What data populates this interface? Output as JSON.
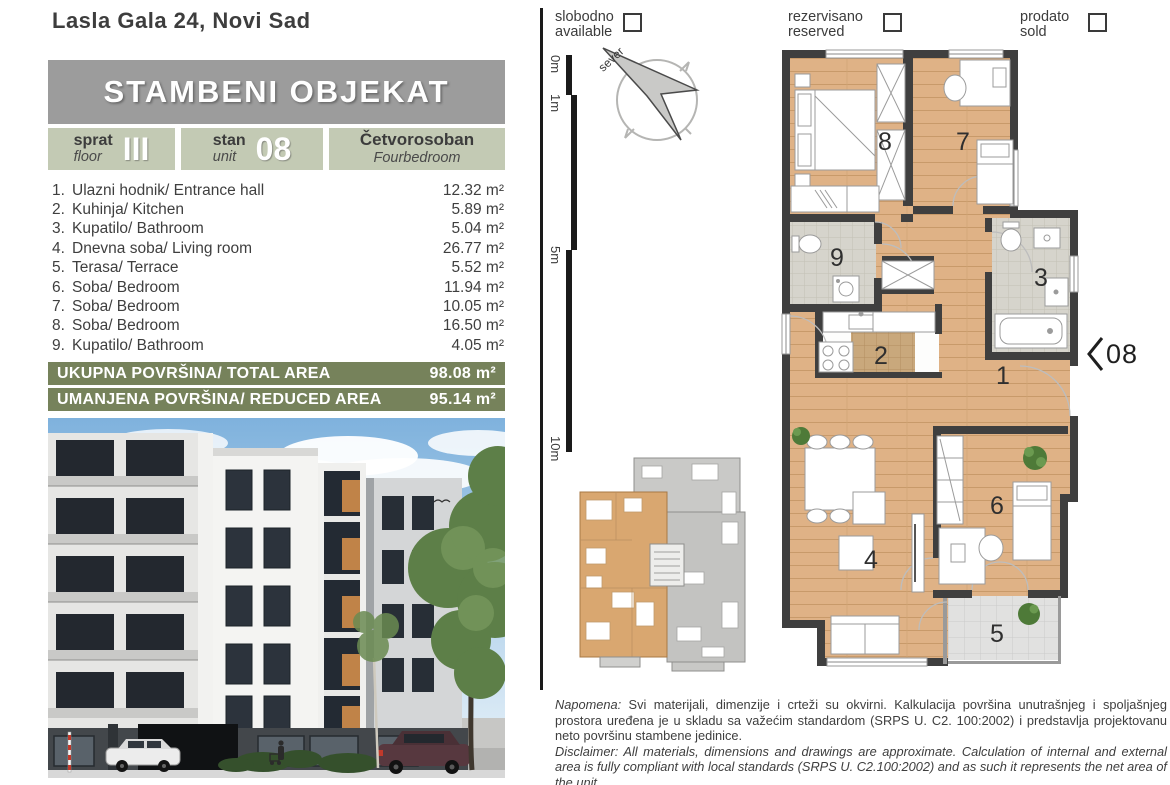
{
  "page": {
    "title": "Lasla Gala 24, Novi Sad"
  },
  "header": {
    "banner": "STAMBENI OBJEKAT"
  },
  "unit_info": {
    "floor_label_sr": "sprat",
    "floor_label_en": "floor",
    "floor_value": "III",
    "unit_label_sr": "stan",
    "unit_label_en": "unit",
    "unit_value": "08",
    "type_sr": "Četvorosoban",
    "type_en": "Fourbedroom"
  },
  "rooms": [
    {
      "num": "1.",
      "label": "Ulazni hodnik/ Entrance hall",
      "area": "12.32 m²"
    },
    {
      "num": "2.",
      "label": "Kuhinja/ Kitchen",
      "area": "5.89 m²"
    },
    {
      "num": "3.",
      "label": "Kupatilo/ Bathroom",
      "area": "5.04 m²"
    },
    {
      "num": "4.",
      "label": "Dnevna soba/ Living room",
      "area": "26.77 m²"
    },
    {
      "num": "5.",
      "label": "Terasa/ Terrace",
      "area": "5.52 m²"
    },
    {
      "num": "6.",
      "label": "Soba/ Bedroom",
      "area": "11.94 m²"
    },
    {
      "num": "7.",
      "label": "Soba/ Bedroom",
      "area": "10.05 m²"
    },
    {
      "num": "8.",
      "label": "Soba/ Bedroom",
      "area": "16.50 m²"
    },
    {
      "num": "9.",
      "label": "Kupatilo/ Bathroom",
      "area": "4.05 m²"
    }
  ],
  "totals": {
    "total_label": "UKUPNA POVRŠINA/ TOTAL AREA",
    "total_value": "98.08 m²",
    "reduced_label": "UMANJENA POVRŠINA/ REDUCED AREA",
    "reduced_value": "95.14 m²"
  },
  "legend": [
    {
      "sr": "slobodno",
      "en": "available"
    },
    {
      "sr": "rezervisano",
      "en": "reserved"
    },
    {
      "sr": "prodato",
      "en": "sold"
    }
  ],
  "scale": {
    "marks": [
      "0m",
      "1m",
      "5m",
      "10m"
    ]
  },
  "compass": {
    "label": "sever"
  },
  "plan": {
    "room_labels": [
      "1",
      "2",
      "3",
      "4",
      "5",
      "6",
      "7",
      "8",
      "9"
    ],
    "entrance_label": "08"
  },
  "disclaimer": {
    "sr_label": "Napomena:",
    "sr_text": " Svi materijali, dimenzije i crteži su okvirni. Kalkulacija površina unutrašnjeg i spoljašnjeg prostora uređena je u skladu sa važećim standardom (SRPS U. C2. 100:2002) i predstavlja projektovanu neto površinu stambene jedinice.",
    "en_label": "Disclaimer:",
    "en_text": " All materials, dimensions and drawings are approximate. Calculation of internal and external area is fully compliant with local standards (SRPS U. C2.100:2002) and as such it represents the net area of the unit."
  },
  "colors": {
    "accent_olive": "#76825B",
    "sage_box": "#C3CAB4",
    "banner_gray": "#9C9C9C",
    "wall_dark": "#3F3F3F",
    "wood_floor": "#DFB286",
    "highlight_unit": "#D9A770"
  }
}
